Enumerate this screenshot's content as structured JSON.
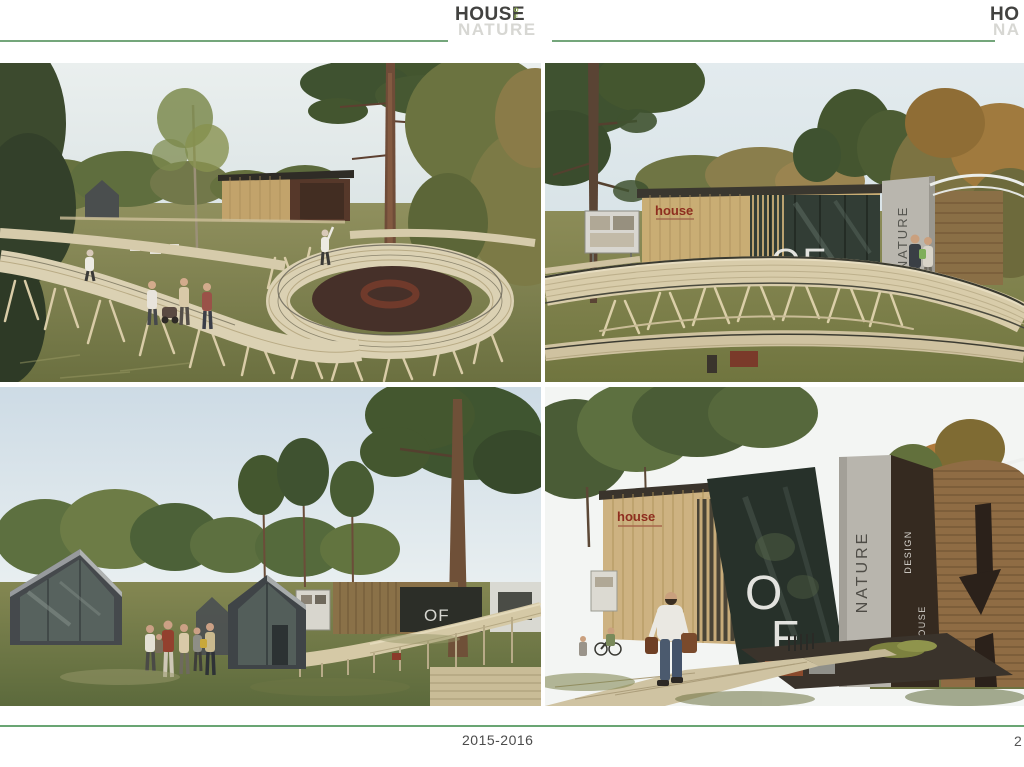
{
  "header": {
    "logo": {
      "title": "HOUSE",
      "of": "OF",
      "subtitle": "NATURE"
    },
    "partial_logo": {
      "title": "HO",
      "subtitle": "NA"
    }
  },
  "footer": {
    "years": "2015-2016",
    "page": "2"
  },
  "photos": {
    "top_right": {
      "house_sign": "house",
      "of_sign": "OF",
      "nature_sign": "NATURE"
    },
    "bottom_left": {
      "of_sign": "OF"
    },
    "bottom_right": {
      "house_sign": "house",
      "of_letters": [
        "O",
        "F"
      ],
      "nature_sign": "NATURE",
      "design_vertical": "DESIGN",
      "house_vertical": "HOUSE"
    }
  },
  "colors": {
    "accent_green": "#74a67b",
    "footer_green": "#69a573",
    "logo_green": "#8fae4e",
    "logo_dark": "#424240",
    "logo_light": "#d7d7d3",
    "sign_red": "#8e2e1f",
    "concrete": "#b8b5ad",
    "wood_light": "#d9cdab",
    "wood_tan": "#c9ad74",
    "wood_brown": "#8f6c44",
    "glass_dark": "#2b352e",
    "grass": "#8c8c58",
    "sky": "#e2eaec"
  }
}
